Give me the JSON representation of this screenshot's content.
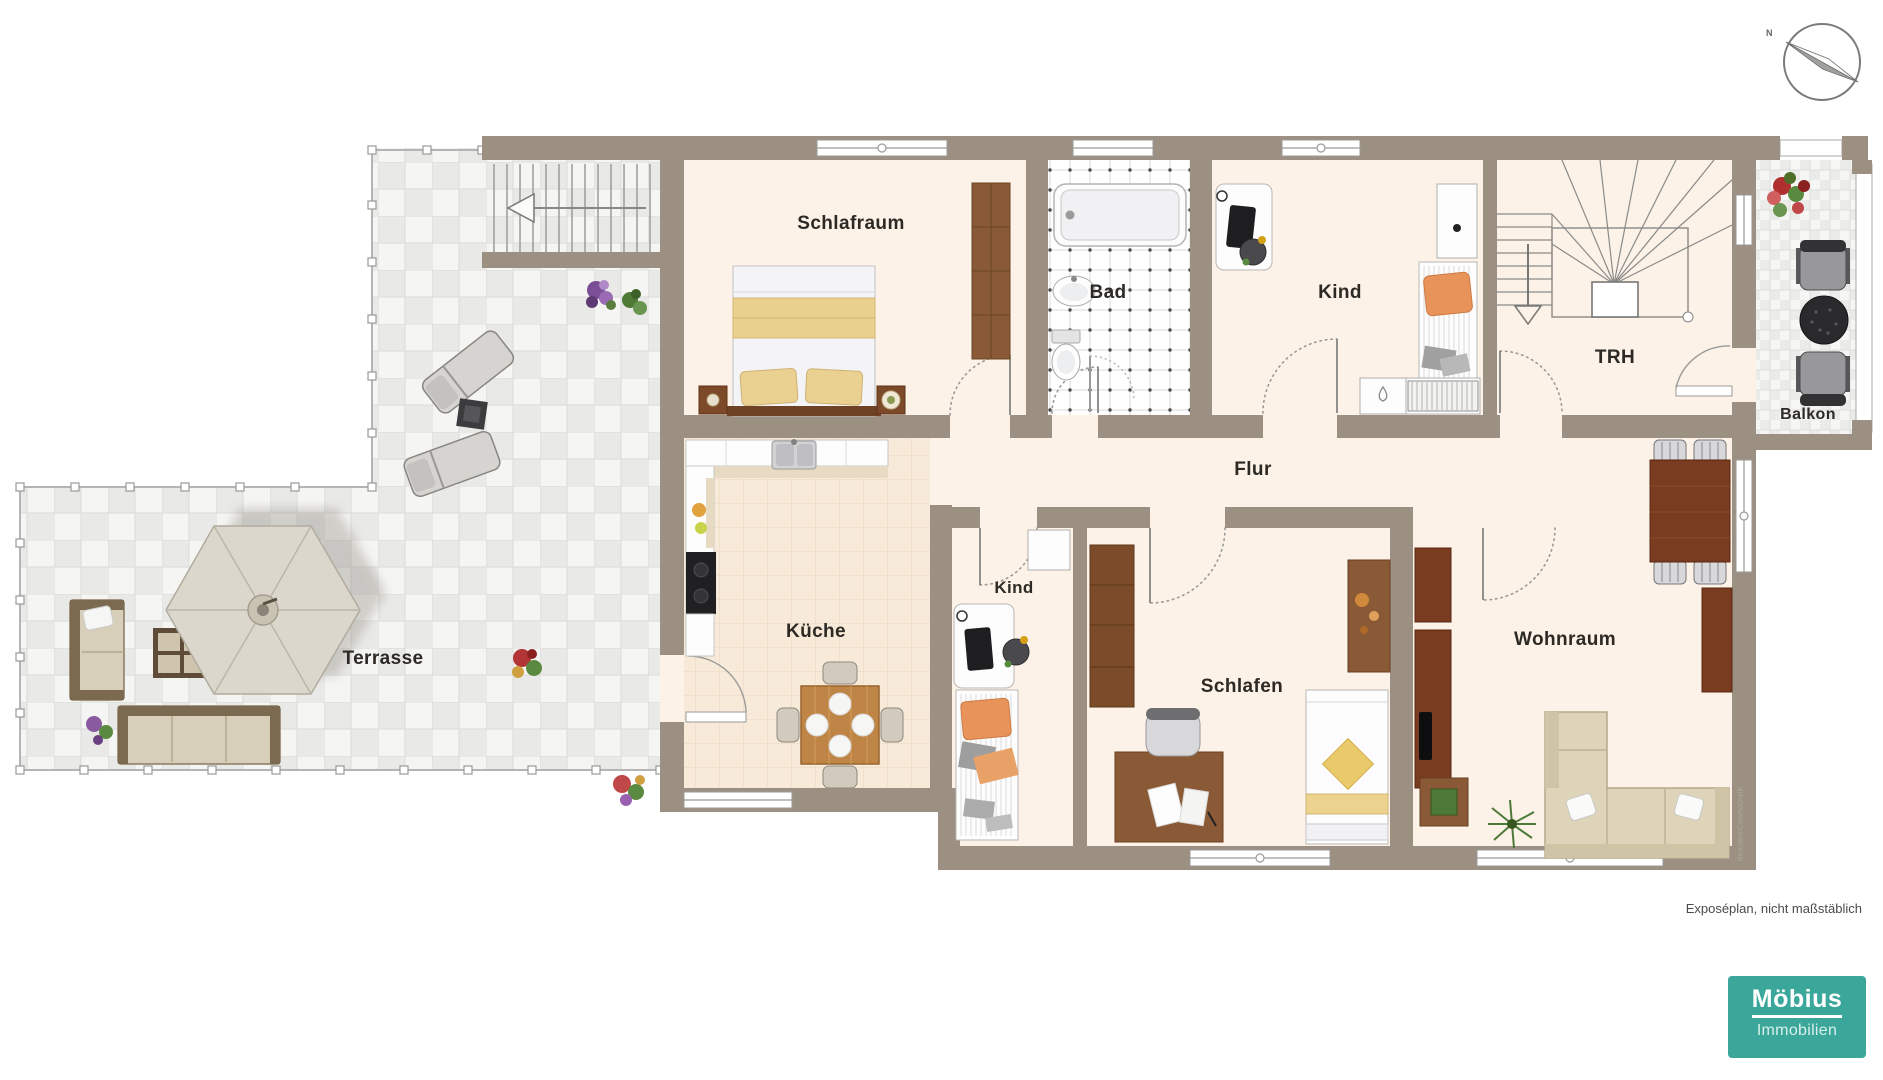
{
  "plan": {
    "footnote": "Exposéplan, nicht maßstäblich",
    "watermark": "IllustrationCommoGrafik",
    "compass_north": "N"
  },
  "logo": {
    "name": "Möbius",
    "division": "Immobilien",
    "background": "#3BA79B"
  },
  "colors": {
    "wall": "#9c9083",
    "floor": "#fcf2e8",
    "kitchen_floor": "#f8ead9",
    "accent_teal": "#3BA79B"
  },
  "rooms": [
    {
      "id": "schlafraum",
      "label": "Schlafraum",
      "x": 851,
      "y": 224,
      "size": 19
    },
    {
      "id": "bad",
      "label": "Bad",
      "x": 1108,
      "y": 293,
      "size": 19
    },
    {
      "id": "kind-oben",
      "label": "Kind",
      "x": 1340,
      "y": 293,
      "size": 19
    },
    {
      "id": "trh",
      "label": "TRH",
      "x": 1615,
      "y": 358,
      "size": 19
    },
    {
      "id": "balkon",
      "label": "Balkon",
      "x": 1808,
      "y": 415,
      "size": 16
    },
    {
      "id": "flur",
      "label": "Flur",
      "x": 1253,
      "y": 470,
      "size": 19
    },
    {
      "id": "kueche",
      "label": "Küche",
      "x": 816,
      "y": 632,
      "size": 19
    },
    {
      "id": "kind-mitte",
      "label": "Kind",
      "x": 1014,
      "y": 588,
      "size": 17
    },
    {
      "id": "schlafen",
      "label": "Schlafen",
      "x": 1242,
      "y": 687,
      "size": 19
    },
    {
      "id": "wohnraum",
      "label": "Wohnraum",
      "x": 1565,
      "y": 640,
      "size": 19
    },
    {
      "id": "terrasse",
      "label": "Terrasse",
      "x": 383,
      "y": 659,
      "size": 19
    }
  ]
}
